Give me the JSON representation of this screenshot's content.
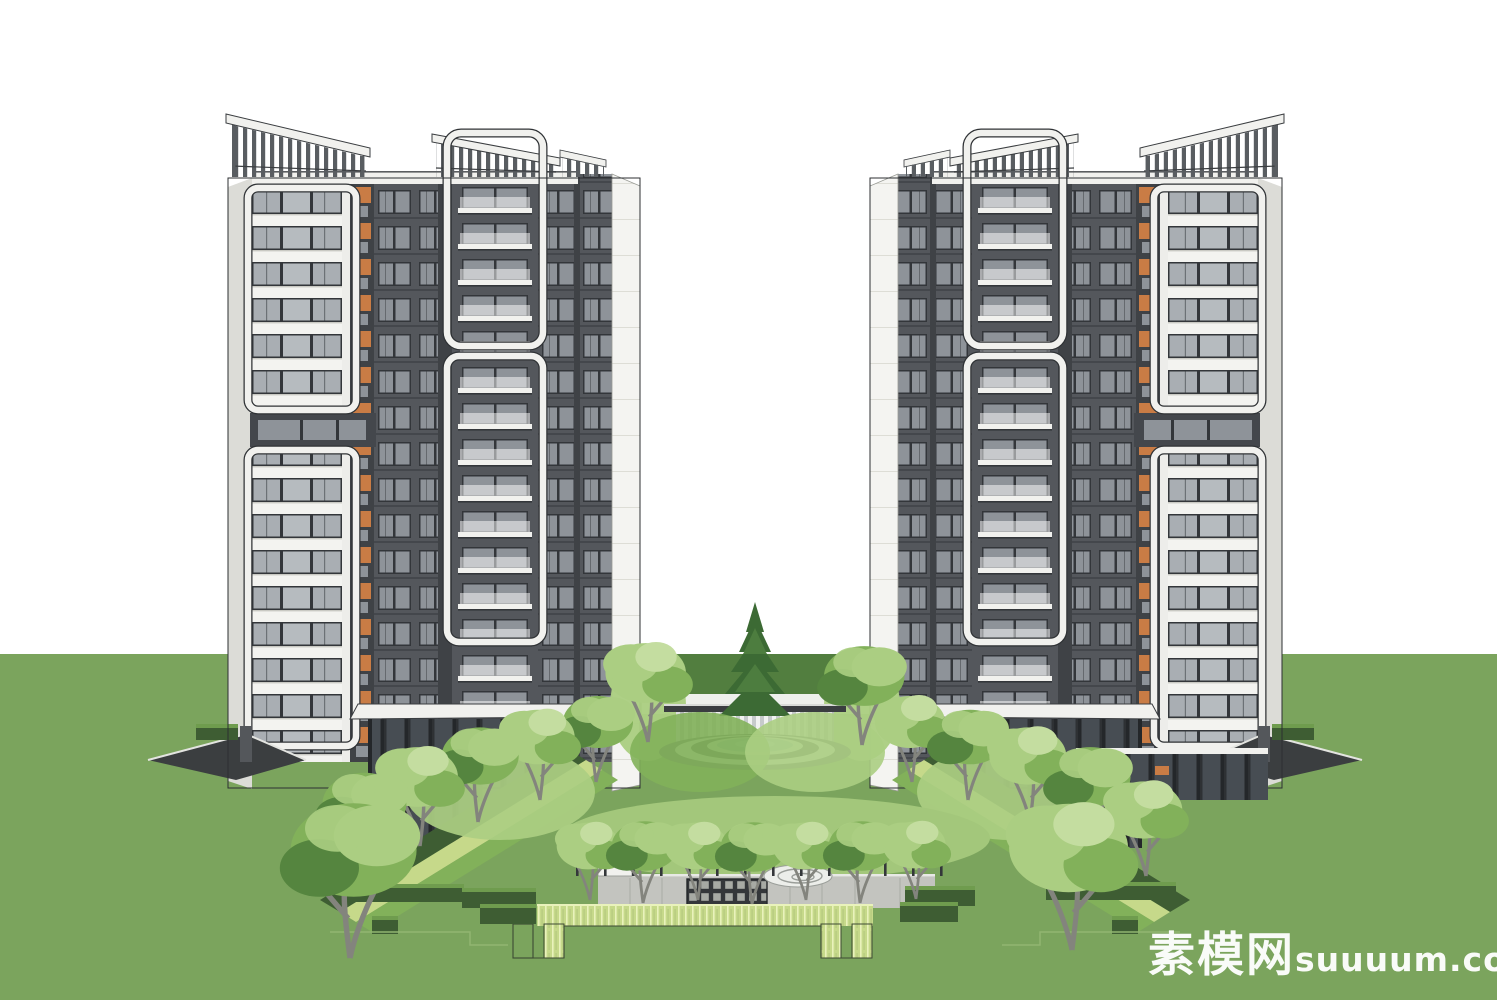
{
  "watermark": {
    "site_name": "素模网",
    "site_domain": "suuuum.com"
  },
  "scene": {
    "setting": "twin high-rise residential towers flanking a central landscaped courtyard on a lawn",
    "tower_count": 2,
    "visible_floors_per_tower": 16,
    "elements": [
      "rooftop-pergola-trellises",
      "white-framed-balcony-stacks",
      "orange-accent-panels",
      "glazed-entrance-portals",
      "circular-courtyard-pavilion",
      "central-pine-tree",
      "reflecting-pool",
      "tree-lined-garden-axis",
      "entry-lattice-screen-wall",
      "spiral-ground-feature",
      "ornamental-grass-parterre",
      "perimeter-lawn"
    ]
  },
  "palette": {
    "sky": "#ffffff",
    "lawn": "#7ba45d",
    "lawn_far": "#527e3f",
    "paving_far": "#eef0ec",
    "facade_white": "#f3f3f0",
    "facade_shadow": "#dcdcd7",
    "facade_dark": "#54575c",
    "facade_darker": "#3f4246",
    "window_frame": "#33363a",
    "window_glass": "#a9aeb3",
    "window_glass_dark": "#8e9399",
    "accent_orange": "#c97c45",
    "pergola_slat": "#595d61",
    "canopy_white": "#f1f1ee",
    "tree_light": "#abce82",
    "tree_mid": "#82b15a",
    "tree_dark": "#55853f",
    "conifer": "#3c6a34",
    "trunk": "#83847d",
    "hedge_dark": "#3e5d33",
    "hedge_top": "#6f9c4e",
    "grass_bed": "#c6d98a",
    "grass_bed_light": "#e9f2bb",
    "plaza": "#c3c4bf",
    "lattice": "#34373a",
    "lattice_cell": "#a7aaa4",
    "water": "#a8c9cc",
    "ring_dark": "#5b5f63",
    "ring_light": "#e8eae8",
    "watermark_white": "#ffffff"
  }
}
